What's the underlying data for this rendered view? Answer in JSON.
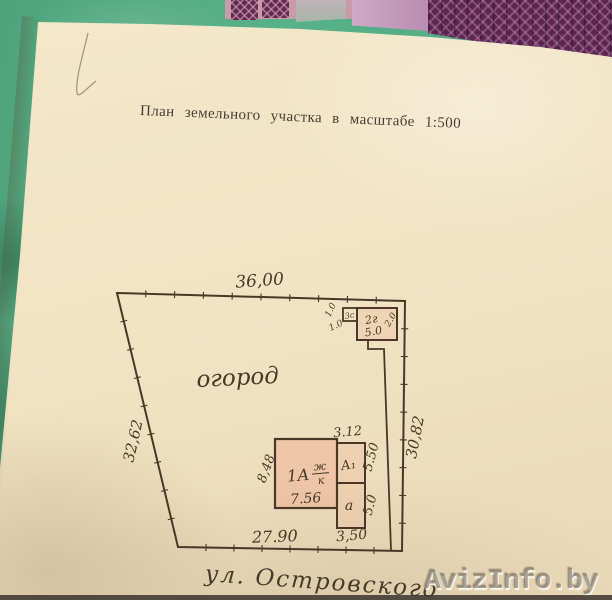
{
  "page": {
    "title": "План земельного участка в масштабе 1:500",
    "street": "ул. Островского",
    "watermark": "AvizInfo.by"
  },
  "plan": {
    "garden": "огород",
    "outline": {
      "top": "36,00",
      "left": "32,62",
      "right": "30,82",
      "bottom": "27.90"
    },
    "house": {
      "number": "1А",
      "material_top": "ж",
      "material_bottom": "к",
      "width": "7.56",
      "depth": "8,48"
    },
    "annex_a1": {
      "label": "А₁",
      "width": "3.12",
      "depth": "5.50"
    },
    "annex_a": {
      "label": "а",
      "depth": "5.0",
      "width": "3,50"
    },
    "garage": {
      "label": "2г",
      "width": "5.0",
      "side": "2.0"
    },
    "shed": {
      "label": "3с",
      "dim1": "1.0",
      "dim2": "1.0"
    }
  },
  "colors": {
    "paper": "#f1e3c4",
    "ink": "#4a3827",
    "surface_teal": "#55ad84",
    "pattern_purple": "#5c2650",
    "pattern_lilac": "#c4a0bf",
    "building_fill": "#ec987c",
    "watermark_gray": "#7a7268"
  }
}
